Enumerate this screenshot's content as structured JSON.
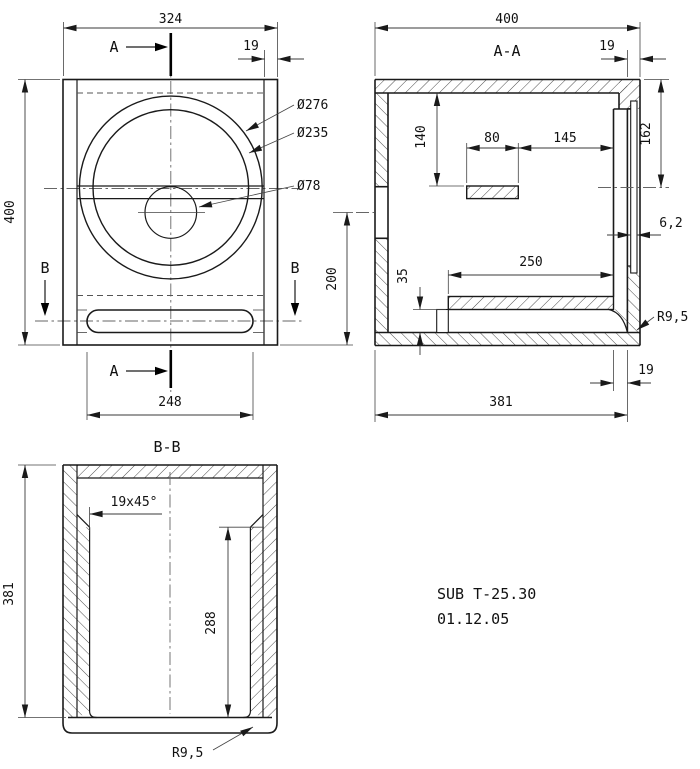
{
  "drawing": {
    "title": "SUB T-25.30",
    "date": "01.12.05",
    "colors": {
      "line": "#1a1a1a",
      "background": "#ffffff"
    },
    "front_view": {
      "section_label_a": "A",
      "section_label_b": "B",
      "dim_width": "324",
      "dim_wall": "19",
      "dim_height": "400",
      "dim_port_center": "200",
      "dim_slot_width": "248",
      "dia_outer": "Ø276",
      "dia_inner": "Ø235",
      "dia_port": "Ø78"
    },
    "section_aa": {
      "title": "A-A",
      "dim_depth": "400",
      "dim_wall_top": "19",
      "dim_driver_center": "162",
      "dim_brace_drop": "140",
      "dim_brace_width": "80",
      "dim_brace_to_back": "145",
      "dim_panel_thickness": "6,2",
      "dim_shelf_length": "250",
      "dim_port_height": "35",
      "dim_wall_bottom": "19",
      "dim_inner_depth": "381",
      "radius_note": "R9,5"
    },
    "section_bb": {
      "title": "B-B",
      "dim_depth": "381",
      "chamfer_note": "19x45°",
      "dim_liner_length": "288",
      "radius_note": "R9,5"
    }
  }
}
